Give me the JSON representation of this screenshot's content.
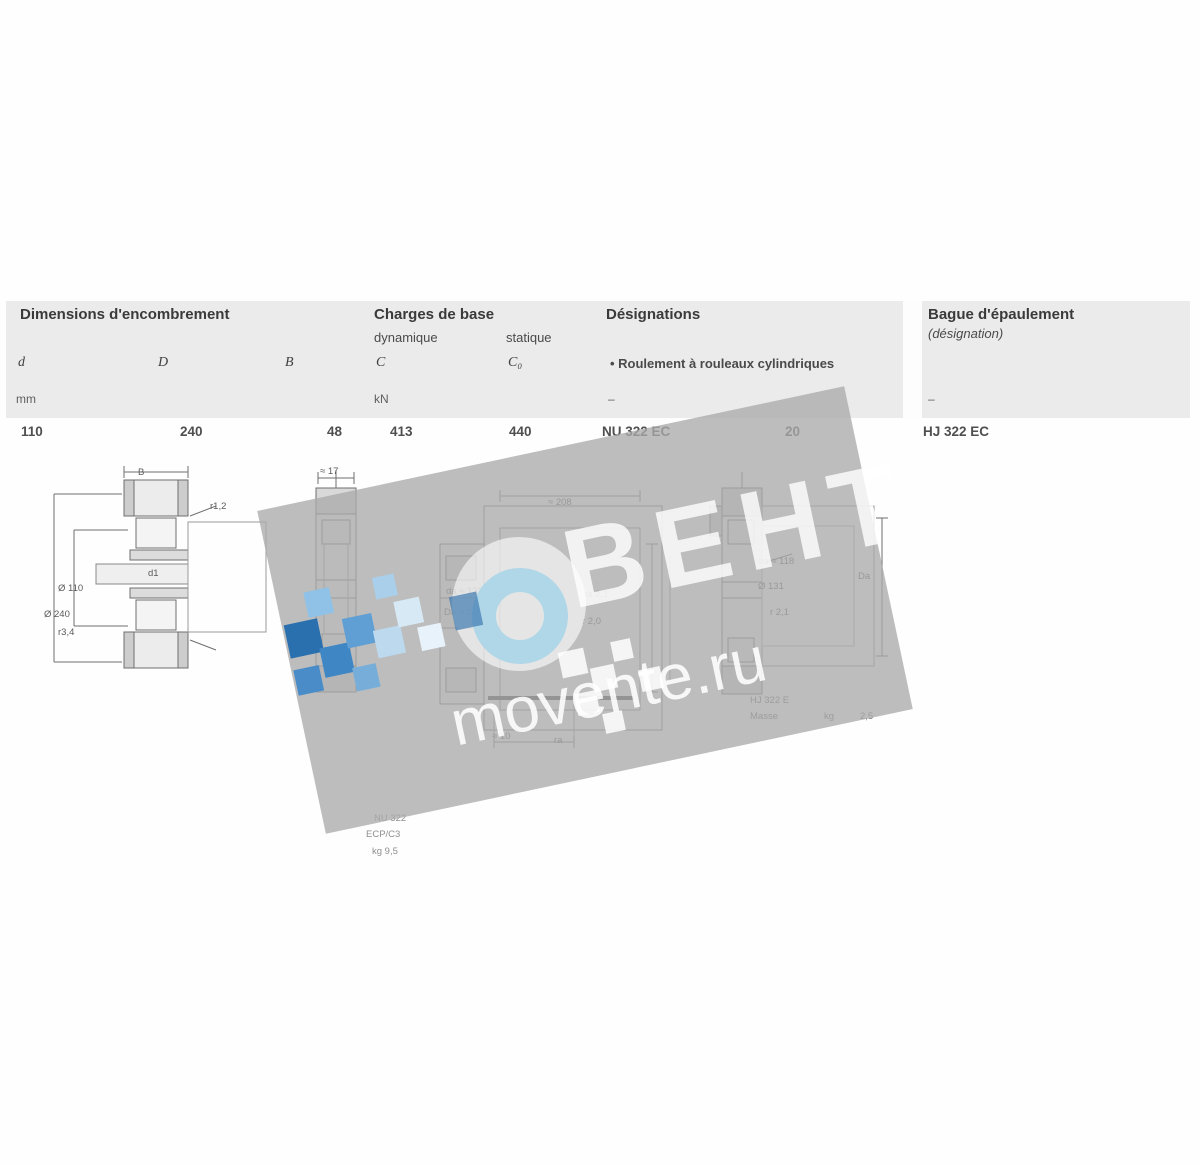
{
  "table": {
    "groups": {
      "dimensions": {
        "title": "Dimensions d'encombrement",
        "sym_d": "d",
        "sym_D": "D",
        "sym_B": "B",
        "units": "mm"
      },
      "load_ratings": {
        "title": "Charges de base",
        "sub_dynamic": "dynamique",
        "sub_static": "statique",
        "sym_C": "C",
        "sym_C0": "C₀",
        "units": "kN"
      },
      "designations": {
        "title": "Désignations",
        "sub": "• Roulement à rouleaux cylindriques",
        "units": "–"
      },
      "angle_ring": {
        "title": "Bague d'épaulement",
        "sub": "(désignation)",
        "units": "–"
      }
    },
    "row": {
      "d": "110",
      "D": "240",
      "B": "48",
      "C": "413",
      "C0": "440",
      "bearing": "NU 322 EC",
      "mass": "20",
      "angle_ring": "HJ 322 EC"
    }
  },
  "watermark": {
    "brand": "ВЕНТ",
    "site": "movente.ru",
    "panel_color": "#ababab"
  },
  "figures": {
    "fig1": {
      "dim_B": "B",
      "dim_r12": "r1,2",
      "dim_d1": "d1",
      "dim_bore": "Ø 110",
      "dim_outer": "Ø 240",
      "dim_r34": "r3,4"
    },
    "fig2": {
      "dim_top": "≈ 17"
    },
    "fig2_caption": {
      "line1": "NU 322",
      "line2": "ECP/C3",
      "line3": "kg 9,5"
    },
    "fig3": {
      "dim_top": "≈ 208",
      "dim_da": "da ≈ 122",
      "dim_Da": "Da ≈ 218",
      "dim_ra": "ra 2,1",
      "dim_rb": "r 2,0",
      "dim_b1": "≈ 10",
      "dim_b2": "ra"
    },
    "fig4": {
      "dim_da": "da ≈ 118",
      "dim_d1": "Ø 131",
      "dim_r": "r 2,1",
      "dim_Da": "Da",
      "caption_designation": "HJ 322 E",
      "caption_mass_label": "Masse",
      "caption_mass_unit": "kg",
      "caption_mass_value": "2,5"
    }
  }
}
